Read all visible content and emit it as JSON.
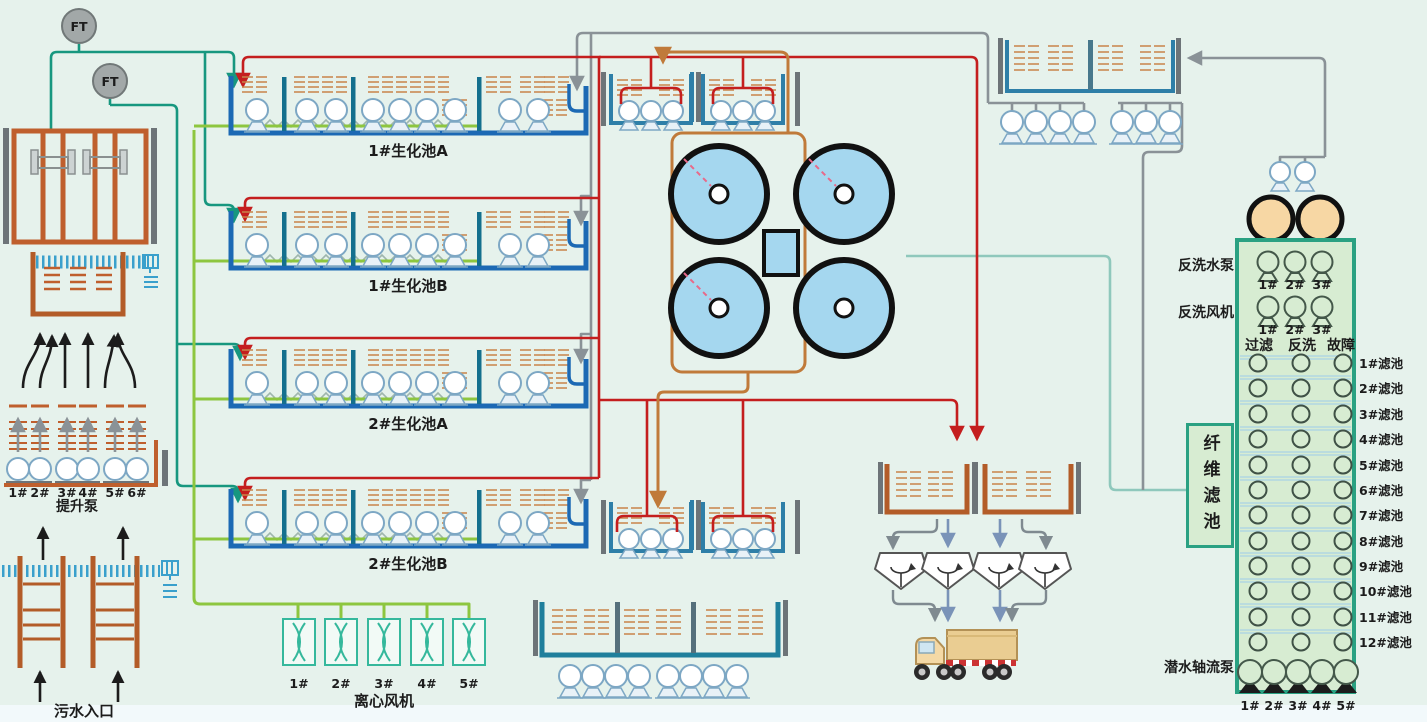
{
  "sensors": {
    "ft1": "FT",
    "ft2": "FT"
  },
  "intake": {
    "inlet_label": "污水入口",
    "lift_pump_label": "提升泵",
    "lift_pump_numbers": [
      "1#",
      "2#",
      "3#",
      "4#",
      "5#",
      "6#"
    ]
  },
  "bio_tanks": {
    "tank1a": "1#生化池A",
    "tank1b": "1#生化池B",
    "tank2a": "2#生化池A",
    "tank2b": "2#生化池B"
  },
  "blowers": {
    "label": "离心风机",
    "numbers": [
      "1#",
      "2#",
      "3#",
      "4#",
      "5#"
    ]
  },
  "filter_station": {
    "backwash_pump_label": "反洗水泵",
    "backwash_pump_numbers": [
      "1#",
      "2#",
      "3#"
    ],
    "backwash_fan_label": "反洗风机",
    "backwash_fan_numbers": [
      "1#",
      "2#",
      "3#"
    ],
    "column_headers": [
      "过滤",
      "反洗",
      "故障"
    ],
    "fiber_filter_label": "纤维滤池",
    "rows": [
      "1#滤池",
      "2#滤池",
      "3#滤池",
      "4#滤池",
      "5#滤池",
      "6#滤池",
      "7#滤池",
      "8#滤池",
      "9#滤池",
      "10#滤池",
      "11#滤池",
      "12#滤池"
    ],
    "axial_pump_label": "潜水轴流泵",
    "axial_pump_numbers": [
      "1#",
      "2#",
      "3#",
      "4#",
      "5#"
    ]
  },
  "colors": {
    "background": "#e6f2ec",
    "tank_blue": "#1c69b4",
    "panel_green_fill": "#d7ecd2",
    "panel_border": "#2aa182",
    "pipe_red": "#c41e1e",
    "pipe_teal": "#17977f",
    "pipe_green": "#8dc63f",
    "pipe_orange": "#c07a3a",
    "pipe_gray": "#8a9297",
    "clarifier_fill": "#a5d7ef",
    "pump_tan": "#f7d7a4",
    "structure_brown": "#bf5f2d"
  }
}
